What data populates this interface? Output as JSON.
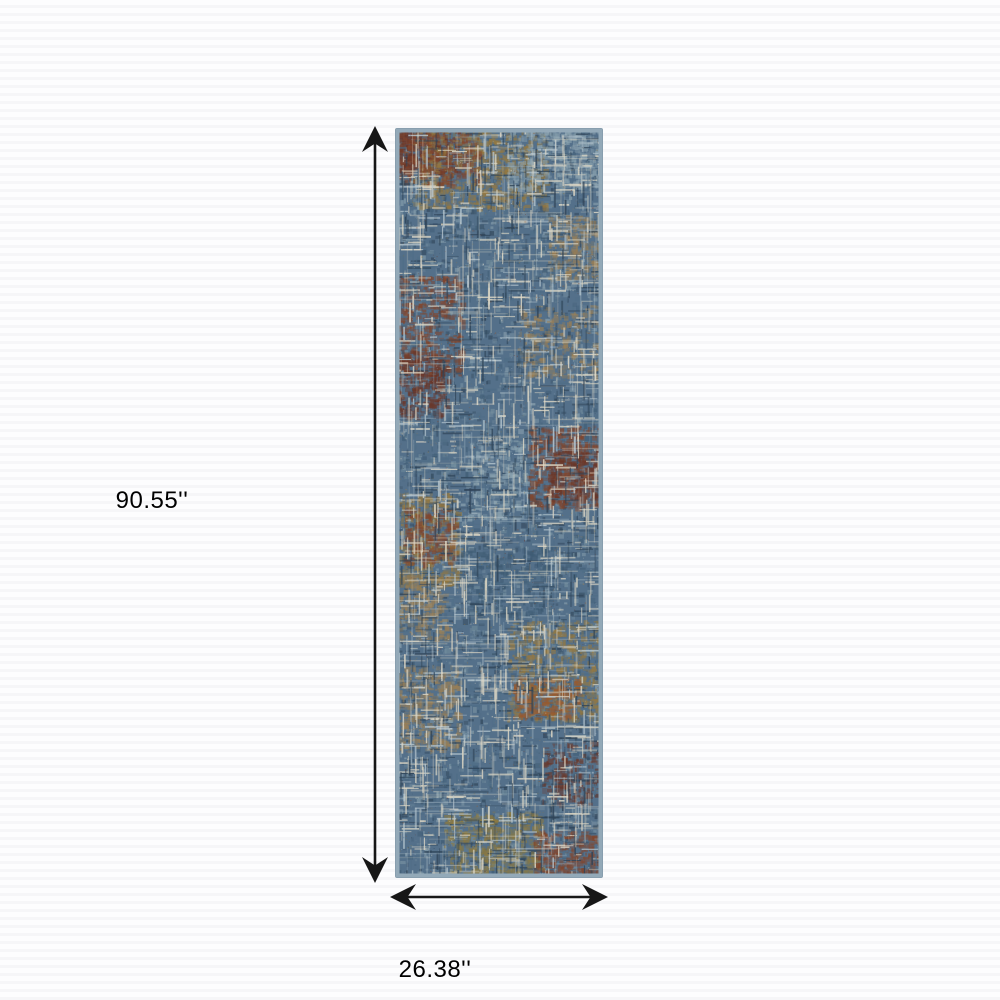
{
  "diagram": {
    "height_label": "90.55''",
    "width_label": "26.38''"
  },
  "style": {
    "arrow_color": "#171717",
    "label_color": "#000000",
    "background_color": "#fdfdfe",
    "stripe_color": "#f6f6f8"
  },
  "rug": {
    "description": "multicolor abstract distressed cross-hatch runner rug",
    "border_color": "#93a9b8",
    "edge_color": "#7d93a4",
    "palette": {
      "base": "#54708a",
      "navy": "#2f4458",
      "steel": "#4f6d86",
      "denim": "#3d5a72",
      "slate": "#76909f",
      "lightsteel": "#8fa6b2",
      "cream": "#ded8c6",
      "pale_blue": "#b6c6cf",
      "maroon": "#6b3526",
      "rust": "#82452c",
      "rust_orange": "#9a5a2d",
      "gold": "#97793f",
      "tan": "#9c8055",
      "olive": "#8d7a40"
    }
  }
}
